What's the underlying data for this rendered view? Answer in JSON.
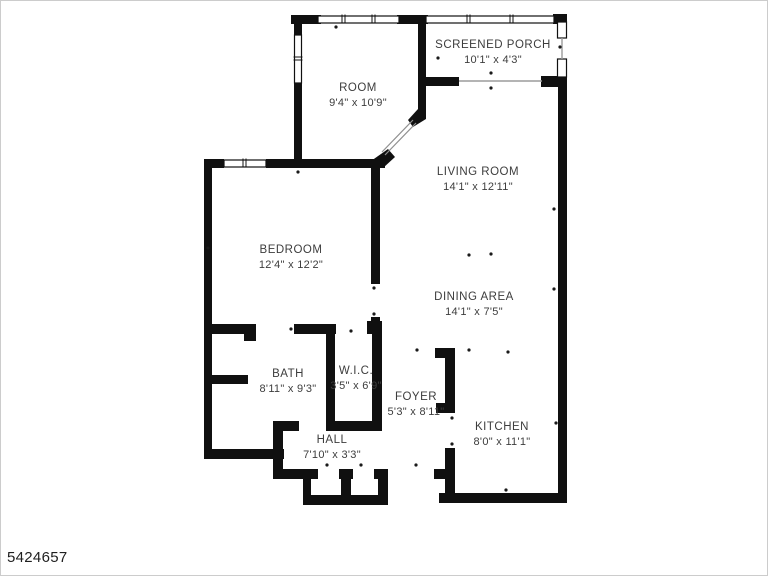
{
  "watermark": {
    "listing_id": "5424657"
  },
  "floor_plan": {
    "wall_color": "#101010",
    "label_color": "#3d3d3d",
    "background": "#ffffff",
    "rooms": [
      {
        "id": "room",
        "name": "ROOM",
        "dims": "9'4\" x 10'9\""
      },
      {
        "id": "screened-porch",
        "name": "SCREENED PORCH",
        "dims": "10'1\" x 4'3\""
      },
      {
        "id": "living-room",
        "name": "LIVING ROOM",
        "dims": "14'1\" x 12'11\""
      },
      {
        "id": "bedroom",
        "name": "BEDROOM",
        "dims": "12'4\" x 12'2\""
      },
      {
        "id": "dining-area",
        "name": "DINING AREA",
        "dims": "14'1\" x 7'5\""
      },
      {
        "id": "bath",
        "name": "BATH",
        "dims": "8'11\" x 9'3\""
      },
      {
        "id": "wic",
        "name": "W.I.C.",
        "dims": "3'5\" x 6'9\""
      },
      {
        "id": "foyer",
        "name": "FOYER",
        "dims": "5'3\" x 8'11\""
      },
      {
        "id": "hall",
        "name": "HALL",
        "dims": "7'10\" x 3'3\""
      },
      {
        "id": "kitchen",
        "name": "KITCHEN",
        "dims": "8'0\" x 11'1\""
      }
    ]
  }
}
